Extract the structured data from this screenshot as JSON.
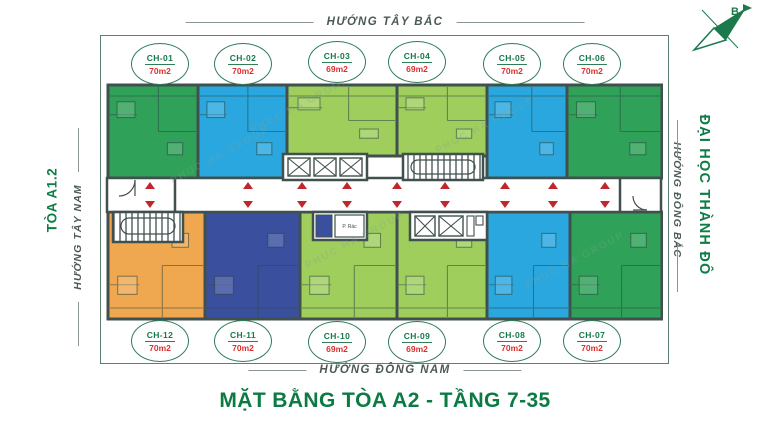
{
  "headers": {
    "top_direction": "HƯỚNG TÂY BẮC",
    "bottom_direction": "HƯỚNG ĐÔNG NAM",
    "left_direction": "HƯỚNG TÂY NAM",
    "right_direction": "HƯỚNG ĐÔNG BẮC",
    "left_building": "TÒA A1.2",
    "right_landmark": "ĐẠI HỌC THÀNH ĐÔ",
    "title": "MẶT BẰNG TÒA A2 - TẦNG 7-35"
  },
  "compass": {
    "north_label": "B"
  },
  "plan": {
    "watermark": "PHUC HA GROUP",
    "trash_room_label": "P. Rác"
  },
  "units": [
    {
      "id": "CH-01",
      "area": "70m2",
      "color": "#2fa158"
    },
    {
      "id": "CH-02",
      "area": "70m2",
      "color": "#2aa7df"
    },
    {
      "id": "CH-03",
      "area": "69m2",
      "color": "#9fce5d"
    },
    {
      "id": "CH-04",
      "area": "69m2",
      "color": "#9fce5d"
    },
    {
      "id": "CH-05",
      "area": "70m2",
      "color": "#2aa7df"
    },
    {
      "id": "CH-06",
      "area": "70m2",
      "color": "#2fa158"
    },
    {
      "id": "CH-07",
      "area": "70m2",
      "color": "#2fa158"
    },
    {
      "id": "CH-08",
      "area": "70m2",
      "color": "#2aa7df"
    },
    {
      "id": "CH-09",
      "area": "69m2",
      "color": "#9fce5d"
    },
    {
      "id": "CH-10",
      "area": "69m2",
      "color": "#9fce5d"
    },
    {
      "id": "CH-11",
      "area": "70m2",
      "color": "#3b4f9f"
    },
    {
      "id": "CH-12",
      "area": "70m2",
      "color": "#f0a850"
    }
  ],
  "colors": {
    "accent_green": "#0e7c45",
    "label_gray_green": "#4b5a54",
    "badge_border": "#2e7d58",
    "area_red": "#d7312e",
    "marker_red": "#c0272d",
    "wall": "#40504e",
    "frame": "#5b7f70",
    "unit_green": "#2fa158",
    "unit_blue": "#2aa7df",
    "unit_lime": "#9fce5d",
    "unit_orange": "#f0a850",
    "unit_indigo": "#3b4f9f"
  }
}
